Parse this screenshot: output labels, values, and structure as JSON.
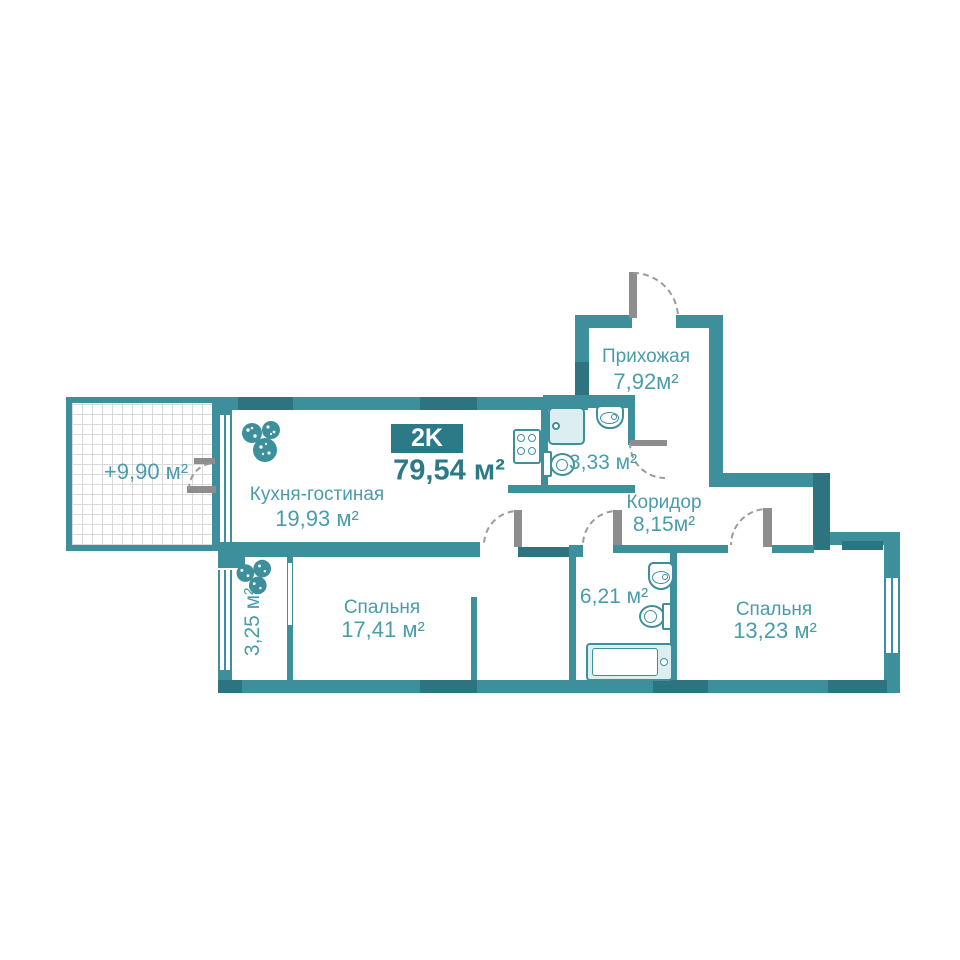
{
  "plan": {
    "type_badge": "2K",
    "total_area": "79,54 м²",
    "rooms": {
      "hallway": {
        "name": "Прихожая",
        "area": "7,92м²"
      },
      "kitchen": {
        "name": "Кухня-гостиная",
        "area": "19,93 м²"
      },
      "bathroom_small": {
        "area": "3,33 м²"
      },
      "corridor": {
        "name": "Коридор",
        "area": "8,15м²"
      },
      "bedroom_1": {
        "name": "Спальня",
        "area": "17,41 м²"
      },
      "bathroom_large": {
        "area": "6,21 м²"
      },
      "bedroom_2": {
        "name": "Спальня",
        "area": "13,23 м²"
      },
      "terrace": {
        "area": "+9,90 м²"
      },
      "loggia": {
        "area": "3,25 м²"
      }
    },
    "colors": {
      "wall": "#3E8F9C",
      "wall_dark": "#2D7380",
      "label_text": "#4A9CAB",
      "badge_background": "#2C7A87",
      "badge_text": "#FFFFFF",
      "fixture_fill": "#DDEEF0",
      "door_leaf": "#8D8D8D",
      "hatch_line": "#D9D9D9"
    }
  }
}
